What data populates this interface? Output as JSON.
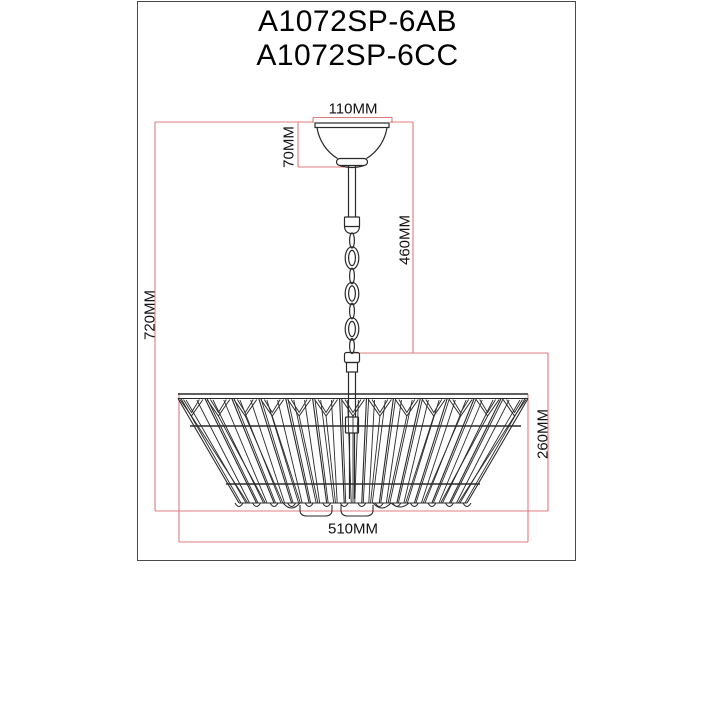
{
  "title": {
    "line1": "A1072SP-6AB",
    "line2": "A1072SP-6CC"
  },
  "dimensions": {
    "canopy_width": {
      "label": "110MM"
    },
    "canopy_height": {
      "label": "70MM"
    },
    "chain_length": {
      "label": "460MM"
    },
    "total_height": {
      "label": "720MM"
    },
    "shade_height": {
      "label": "260MM"
    },
    "shade_diameter": {
      "label": "510MM"
    }
  },
  "colors": {
    "background": "#ffffff",
    "border": "#4a4a4a",
    "drawing_line": "#2a2a2a",
    "dimension_line": "#e07c7c",
    "label_text": "#111111"
  }
}
